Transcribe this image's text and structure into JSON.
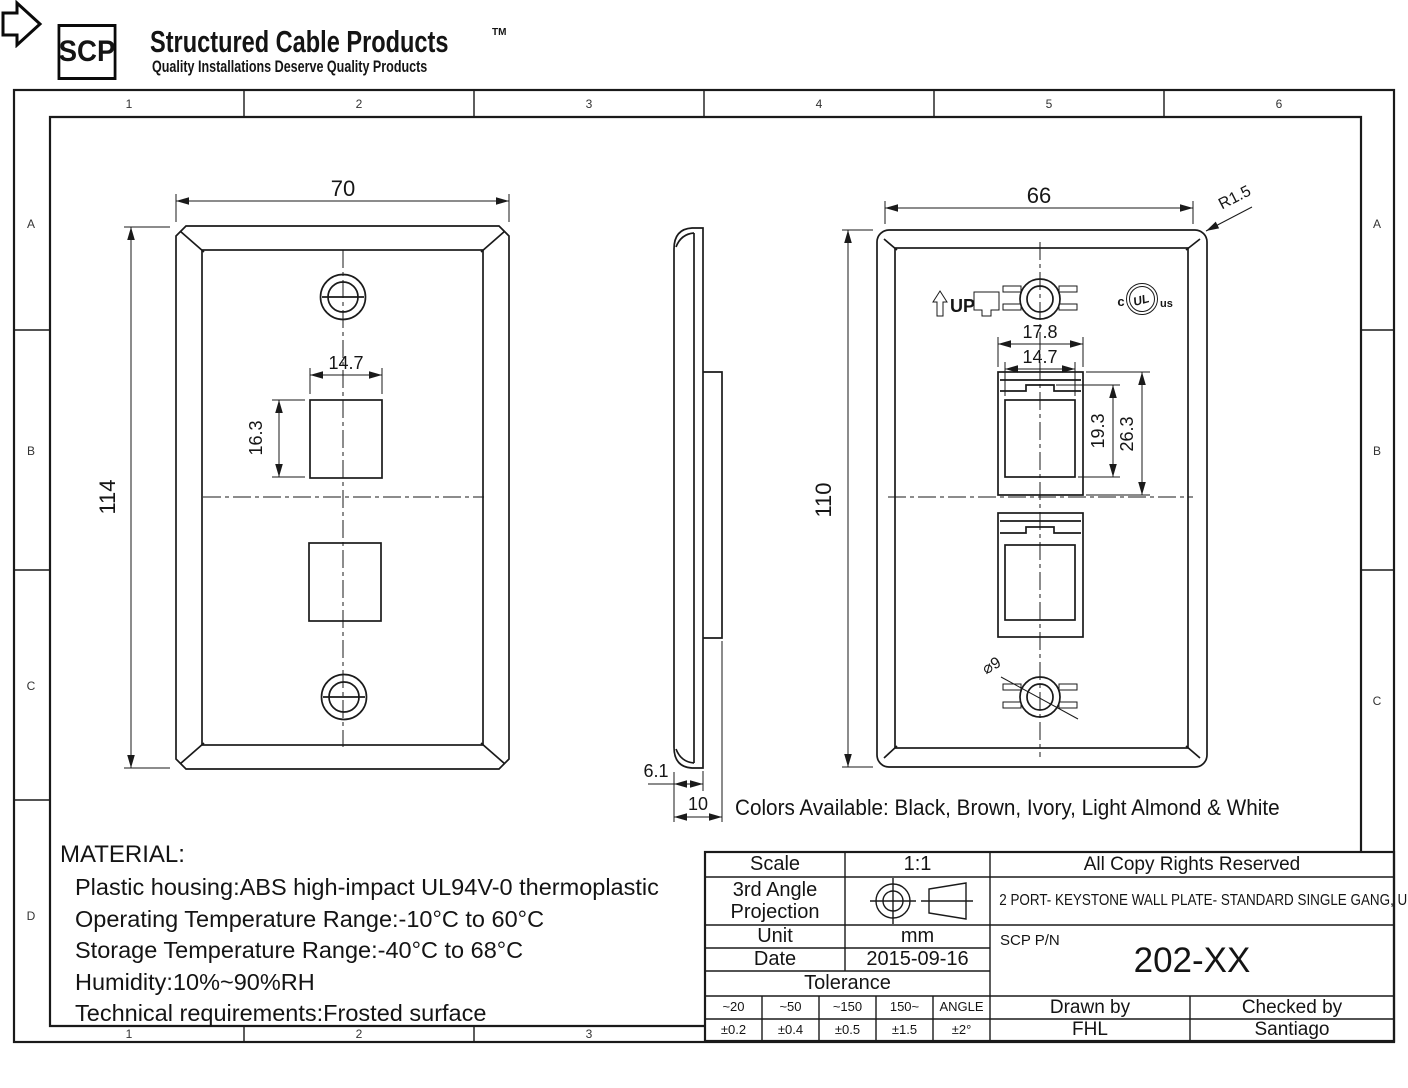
{
  "logo": {
    "abbr": "SCP",
    "brand": "Structured Cable Products",
    "tm": "TM",
    "tagline": "Quality Installations Deserve Quality Products"
  },
  "grid": {
    "top": [
      "1",
      "2",
      "3",
      "4",
      "5",
      "6"
    ],
    "bottom": [
      "1",
      "2",
      "3"
    ],
    "left": [
      "A",
      "B",
      "C",
      "D"
    ],
    "right": [
      "A",
      "B",
      "C"
    ]
  },
  "front_view": {
    "width": "70",
    "height": "114",
    "port_width": "14.7",
    "port_height": "16.3"
  },
  "side_view": {
    "front_thickness": "6.1",
    "total_depth": "10"
  },
  "back_view": {
    "width": "66",
    "height": "110",
    "corner_radius": "R1.5",
    "up_label": "UP",
    "jack_pitch": "17.8",
    "port_width": "14.7",
    "latch_depth": "19.3",
    "port_depth": "26.3",
    "screw_hole_dia": "⌀9",
    "ul_c": "c",
    "ul_mark": "UL",
    "ul_us": "us"
  },
  "colors_note": "Colors Available: Black, Brown, Ivory, Light Almond & White",
  "material": {
    "title": "MATERIAL:",
    "lines": [
      "Plastic housing:ABS high-impact UL94V-0 thermoplastic",
      "Operating Temperature Range:-10°C to 60°C",
      "Storage Temperature Range:-40°C to 68°C",
      "Humidity:10%~90%RH",
      "Technical requirements:Frosted surface"
    ]
  },
  "title_block": {
    "scale_label": "Scale",
    "scale_value": "1:1",
    "copyright": "All Copy Rights Reserved",
    "projection_label": "3rd Angle Projection",
    "description": "2 PORT- KEYSTONE WALL PLATE- STANDARD SINGLE GANG, UL",
    "unit_label": "Unit",
    "unit_value": "mm",
    "date_label": "Date",
    "date_value": "2015-09-16",
    "pn_label": "SCP P/N",
    "pn_value": "202-XX",
    "tolerance_label": "Tolerance",
    "tolerance_headers": [
      "~20",
      "~50",
      "~150",
      "150~",
      "ANGLE"
    ],
    "tolerance_values": [
      "±0.2",
      "±0.4",
      "±0.5",
      "±1.5",
      "±2°"
    ],
    "drawn_label": "Drawn by",
    "drawn_value": "FHL",
    "checked_label": "Checked by",
    "checked_value": "Santiago"
  }
}
